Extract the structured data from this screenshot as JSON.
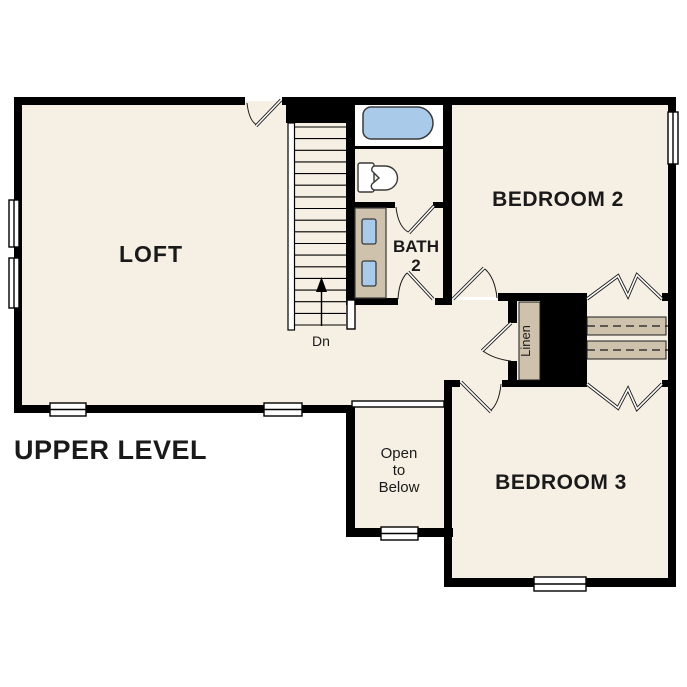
{
  "title": "UPPER LEVEL",
  "rooms": {
    "loft": {
      "label": "LOFT"
    },
    "bedroom2": {
      "label": "BEDROOM 2"
    },
    "bedroom3": {
      "label": "BEDROOM 3"
    },
    "bath": {
      "line1": "BATH",
      "line2": "2"
    },
    "linen": {
      "label": "Linen"
    },
    "open_to_below": {
      "line1": "Open",
      "line2": "to",
      "line3": "Below"
    },
    "stairs": {
      "direction_label": "Dn"
    }
  },
  "colors": {
    "wall": "#000000",
    "floor": "#f6efe3",
    "wet_room_floor": "#ffffff",
    "fixture_blue": "#a9cae9",
    "casework_tan": "#cec2ad",
    "outline": "#3a3a3a"
  }
}
